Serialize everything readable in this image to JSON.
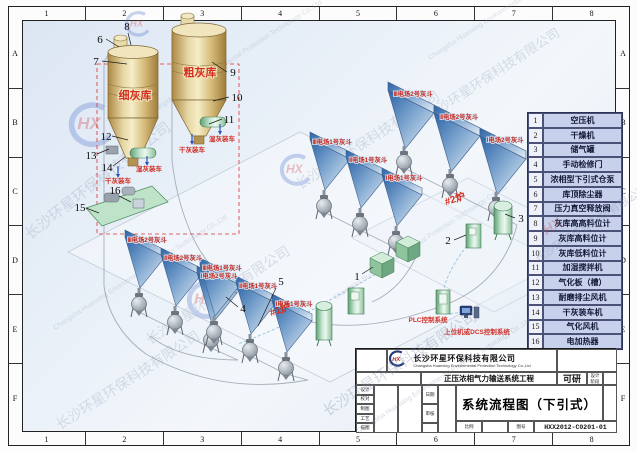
{
  "frame": {
    "cols": [
      "1",
      "2",
      "3",
      "4",
      "5",
      "6",
      "7",
      "8"
    ],
    "rows": [
      "A",
      "B",
      "C",
      "D",
      "E",
      "F"
    ]
  },
  "watermark": {
    "company_cn": "长沙环星环保科技有限公司",
    "company_en": "Changsha Huanxing Environmental Protection Technology Co.,Ltd",
    "logo": "HX"
  },
  "diagram": {
    "silo_fine": "细灰库",
    "silo_coarse": "粗灰库",
    "dry_load": "干灰装车",
    "wet_load": "湿灰装车",
    "boiler1": "#1炉",
    "boiler2": "#2炉",
    "plc": "PLC控制系统",
    "dcs": "上位机或DCS控制系统",
    "callouts": [
      "1",
      "2",
      "3",
      "4",
      "5",
      "6",
      "7",
      "8",
      "9",
      "10",
      "11",
      "12",
      "13",
      "14",
      "15",
      "16"
    ],
    "hopper_rows": [
      {
        "labels": [
          "Ⅲ电场2号灰斗",
          "Ⅱ电场2号灰斗",
          "Ⅰ电场2号灰斗"
        ]
      },
      {
        "labels": [
          "Ⅲ电场1号灰斗",
          "Ⅱ电场1号灰斗",
          "Ⅰ电场1号灰斗"
        ]
      },
      {
        "labels": [
          "Ⅲ电场2号灰斗",
          "Ⅱ电场2号灰斗",
          "Ⅰ电场2号灰斗"
        ]
      },
      {
        "labels": [
          "Ⅲ电场1号灰斗",
          "Ⅱ电场1号灰斗",
          "Ⅰ电场1号灰斗"
        ]
      }
    ]
  },
  "legend": {
    "items": [
      {
        "num": "1",
        "label": "空压机"
      },
      {
        "num": "2",
        "label": "干燥机"
      },
      {
        "num": "3",
        "label": "储气罐"
      },
      {
        "num": "4",
        "label": "手动检修门"
      },
      {
        "num": "5",
        "label": "浓相型下引式仓泵"
      },
      {
        "num": "6",
        "label": "库顶除尘器"
      },
      {
        "num": "7",
        "label": "压力真空释放阀"
      },
      {
        "num": "8",
        "label": "灰库高高料位计"
      },
      {
        "num": "9",
        "label": "灰库高料位计"
      },
      {
        "num": "10",
        "label": "灰库低料位计"
      },
      {
        "num": "11",
        "label": "加湿搅拌机"
      },
      {
        "num": "12",
        "label": "气化板（槽）"
      },
      {
        "num": "13",
        "label": "耐磨排尘风机"
      },
      {
        "num": "14",
        "label": "干灰装车机"
      },
      {
        "num": "15",
        "label": "气化风机"
      },
      {
        "num": "16",
        "label": "电加热器"
      }
    ]
  },
  "titleblock": {
    "logo": "HX",
    "company_cn": "长沙环星环保科技有限公司",
    "company_en": "Changsha Huanxing Environmental Protection Technology Co.,Ltd",
    "project": "正压浓相气力输送系统工程",
    "stage_value": "可研",
    "stage_l1": "设计",
    "stage_l2": "阶段",
    "title": "系统流程图（下引式）",
    "rows_left": [
      "设计",
      "校对",
      "制图",
      "工艺",
      "描图"
    ],
    "mid_labels": [
      "日期",
      "审核"
    ],
    "scale_label": "比例",
    "no_label": "图号",
    "drawing_no": "HXX2012-C0201-01"
  }
}
